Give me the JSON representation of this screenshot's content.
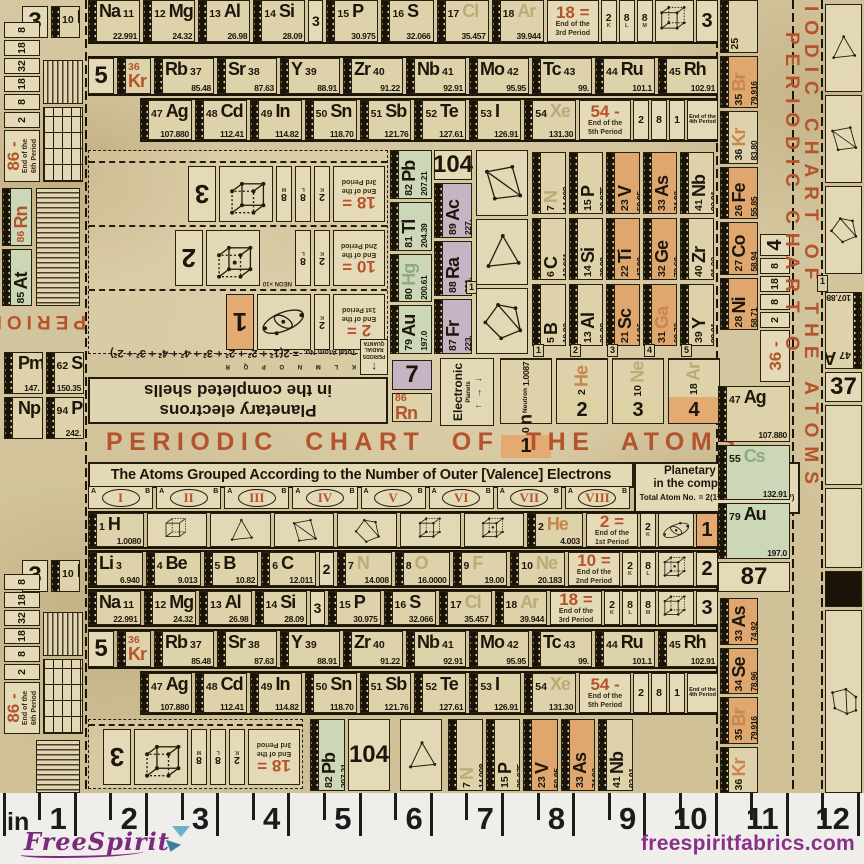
{
  "brand": {
    "name": "FreeSpirit",
    "site": "freespiritfabrics.com",
    "purple": "#7c2a80",
    "teal": "#5fa8c4"
  },
  "ruler": {
    "unit": "in",
    "nums": [
      "1",
      "2",
      "3",
      "4",
      "5",
      "6",
      "7",
      "8",
      "9",
      "10",
      "11",
      "12"
    ]
  },
  "chart": {
    "title": "PERIODIC CHART OF THE ATOMS",
    "subtitle": "The Atoms Grouped According to the Number of Outer [Valence] Electrons",
    "accent": "#b5532c",
    "groups": {
      "numerals": [
        "I",
        "II",
        "III",
        "IV",
        "V",
        "VI",
        "VII",
        "VIII"
      ],
      "a": "A",
      "b": "B"
    },
    "legend": {
      "l1": "Planetary electrons",
      "l2": "in the completed shells",
      "label": "Total Atom No.",
      "eq": "= 2(1²· 2²· 3²· 4²· 4²· 3²· 2²)"
    },
    "planetary": {
      "l1": "Planetary electrons",
      "l2": "in the completed shells",
      "label": "Total Atom No.",
      "letters": "K L M N O P Q R",
      "eq": "= 2(1² + 2² + 2² + 3² + 4² + 4² + 3² + 2²)",
      "axis_v": "PERIODS",
      "axis_h": "RADIAL QUANTA",
      "arrow": "↑"
    },
    "electronic": {
      "title": "Electronic",
      "sub": "Planets",
      "arrows": "↑ → ↓"
    },
    "vertical_title": {
      "t1": "IODIC CHART OF THE ATOMS",
      "t2": "PERIODIC CHART O"
    },
    "selvage_title_fragment": "PERIODIC"
  },
  "rows": {
    "p3": [
      {
        "n": "11",
        "s": "Na",
        "w": "22.991",
        "f": 1
      },
      {
        "n": "12",
        "s": "Mg",
        "w": "24.32"
      },
      {
        "n": "13",
        "s": "Al",
        "w": "26.98"
      },
      {
        "n": "14",
        "s": "Si",
        "w": "28.09"
      },
      {
        "d": "3"
      },
      {
        "n": "15",
        "s": "P",
        "w": "30.975"
      },
      {
        "n": "16",
        "s": "S",
        "w": "32.066"
      },
      {
        "n": "17",
        "s": "Cl",
        "w": "35.457",
        "c": "ghost"
      },
      {
        "n": "18",
        "s": "Ar",
        "w": "39.944",
        "c": "ghost"
      }
    ],
    "p5a": [
      {
        "k": "idx",
        "n": "5"
      },
      {
        "n": "36",
        "s": "Kr",
        "c": "kr2 stack"
      },
      {
        "n": "37",
        "s": "Rb",
        "w": "85.48",
        "f": 1
      },
      {
        "n": "38",
        "s": "Sr",
        "w": "87.63",
        "f": 1
      },
      {
        "n": "39",
        "s": "Y",
        "w": "88.91",
        "f": 1
      },
      {
        "n": "40",
        "s": "Zr",
        "w": "91.22",
        "f": 1
      },
      {
        "n": "41",
        "s": "Nb",
        "w": "92.91",
        "f": 1
      },
      {
        "n": "42",
        "s": "Mo",
        "w": "95.95",
        "f": 1
      },
      {
        "n": "43",
        "s": "Tc",
        "w": "99.",
        "f": 1
      },
      {
        "n": "44",
        "s": "Ru",
        "w": "101.1"
      },
      {
        "n": "45",
        "s": "Rh",
        "w": "102.91"
      }
    ],
    "p5b": [
      {
        "n": "47",
        "s": "Ag",
        "w": "107.880"
      },
      {
        "n": "48",
        "s": "Cd",
        "w": "112.41"
      },
      {
        "n": "49",
        "s": "In",
        "w": "114.82"
      },
      {
        "n": "50",
        "s": "Sn",
        "w": "118.70"
      },
      {
        "n": "51",
        "s": "Sb",
        "w": "121.76"
      },
      {
        "n": "52",
        "s": "Te",
        "w": "127.61"
      },
      {
        "n": "53",
        "s": "I",
        "w": "126.91"
      },
      {
        "n": "54",
        "s": "Xe",
        "w": "131.30",
        "c": "ghost"
      }
    ],
    "p1a": [
      {
        "n": "1",
        "s": "H",
        "w": "1.0080"
      }
    ],
    "p1b": [
      {
        "n": "2",
        "s": "He",
        "w": "4.003",
        "c": "ghostO"
      }
    ],
    "p2": [
      {
        "n": "3",
        "s": "Li",
        "w": "6.940",
        "f": 1
      },
      {
        "n": "4",
        "s": "Be",
        "w": "9.013"
      },
      {
        "n": "5",
        "s": "B",
        "w": "10.82"
      },
      {
        "n": "6",
        "s": "C",
        "w": "12.011"
      },
      {
        "d": "2"
      },
      {
        "n": "7",
        "s": "N",
        "w": "14.008",
        "c": "ghost"
      },
      {
        "n": "8",
        "s": "O",
        "w": "16.0000",
        "c": "ghost"
      },
      {
        "n": "9",
        "s": "F",
        "w": "19.00",
        "c": "ghost"
      },
      {
        "n": "10",
        "s": "Ne",
        "w": "20.183",
        "c": "ghost"
      }
    ]
  },
  "caps": {
    "c1": {
      "big": "2 =",
      "cap": "End of the|1st Period",
      "shells": [
        "2"
      ],
      "letters": [
        "K"
      ],
      "box": "H",
      "idx": "1",
      "idxc": "ob"
    },
    "c2": {
      "big": "10 =",
      "cap": "End of the|2nd Period",
      "shells": [
        "2",
        "8"
      ],
      "letters": [
        "K",
        "L"
      ],
      "box": "G",
      "idx": "2"
    },
    "c3": {
      "big": "18 =",
      "cap": "End of the|3rd Period",
      "shells": [
        "2",
        "8",
        "8"
      ],
      "letters": [
        "K",
        "L",
        "M"
      ],
      "box": "F",
      "idx": "3"
    },
    "c54": {
      "big": "54 -",
      "cap": "End of the|5th Period",
      "shells": [
        "2",
        "8",
        "1"
      ],
      "side": "End of the|4th Period"
    },
    "c36": {
      "big": "36 -",
      "shells": [
        "2",
        "8",
        "18",
        "8"
      ],
      "idx": "4"
    },
    "c86": {
      "big": "86 -",
      "cap": "End of the|6th Period",
      "shells": [
        "2",
        "8",
        "18",
        "32",
        "18",
        "8"
      ]
    }
  },
  "mid": {
    "blocks": [
      {
        "idx": "1",
        "idxc": "ob",
        "box": "H",
        "shells": [
          "2"
        ],
        "letters": [
          "K"
        ],
        "big": "2 =",
        "cap": "End of the|1st Period"
      },
      {
        "idx": "2",
        "box": "G",
        "shells": [
          "2",
          "8"
        ],
        "letters": [
          "K",
          "L"
        ],
        "big": "10 =",
        "cap": "End of the|2nd Period",
        "note": "NEON ×10"
      },
      {
        "idx": "3",
        "box": "F",
        "shells": [
          "2",
          "8",
          "8"
        ],
        "letters": [
          "K",
          "L",
          "M"
        ],
        "big": "18 =",
        "cap": "End of the|3rd Period"
      }
    ],
    "greens": [
      {
        "n": "82",
        "s": "Pb",
        "w": "207.21",
        "c": "gbg"
      },
      {
        "n": "81",
        "s": "Tl",
        "w": "204.39",
        "c": "gbg"
      },
      {
        "n": "80",
        "s": "Hg",
        "w": "200.61",
        "c": "gbg ghostg"
      },
      {
        "n": "79",
        "s": "Au",
        "w": "197.0",
        "c": "gbg"
      }
    ],
    "purples": [
      {
        "n": "104",
        "c": "pbg",
        "k": "idx"
      },
      {
        "n": "89",
        "s": "Ac",
        "w": "227.",
        "c": "pbg"
      },
      {
        "n": "88",
        "s": "Ra",
        "w": "226.",
        "c": "pbg"
      },
      {
        "n": "87",
        "s": "Fr",
        "w": "223.",
        "c": "pbg"
      }
    ],
    "con_label": "1",
    "grid": {
      "nums": [
        "1",
        "2",
        "3",
        "4",
        "5"
      ],
      "rows": [
        [
          {
            "n": "7",
            "s": "N",
            "w": "14.008",
            "c": "ghost"
          },
          {
            "n": "15",
            "s": "P",
            "w": "30.975"
          },
          {
            "n": "23",
            "s": "V",
            "w": "50.95",
            "c": "obg"
          },
          {
            "n": "33",
            "s": "As",
            "w": "74.92",
            "c": "obg"
          },
          {
            "n": "41",
            "s": "Nb",
            "w": "92.91"
          }
        ],
        [
          {
            "n": "6",
            "s": "C",
            "w": "12.011"
          },
          {
            "n": "14",
            "s": "Si",
            "w": "28.09"
          },
          {
            "n": "22",
            "s": "Ti",
            "w": "47.90",
            "c": "obg"
          },
          {
            "n": "32",
            "s": "Ge",
            "w": "72.60",
            "c": "obg"
          },
          {
            "n": "40",
            "s": "Zr",
            "w": "91.22"
          }
        ],
        [
          {
            "n": "5",
            "s": "B",
            "w": "10.82"
          },
          {
            "n": "13",
            "s": "Al",
            "w": "26.98"
          },
          {
            "n": "21",
            "s": "Sc",
            "w": "44.96",
            "c": "obg"
          },
          {
            "n": "31",
            "s": "Ga",
            "w": "69.72",
            "c": "obg ghostO"
          },
          {
            "n": "39",
            "s": "Y",
            "w": "88.91"
          }
        ]
      ]
    },
    "electrons": [
      {
        "n": "0",
        "s": "n",
        "x": "Neutron",
        "w": "1.0087",
        "i": "1",
        "ic": "ob"
      },
      {
        "n": "2",
        "s": "He",
        "c": "ghostO",
        "i": "2",
        "ic": ""
      },
      {
        "n": "10",
        "s": "Ne",
        "c": "ghost",
        "i": "3",
        "ic": ""
      },
      {
        "n": "18",
        "s": "Ar",
        "c": "ghost",
        "i": "4",
        "ic": "ob"
      }
    ],
    "pair7": {
      "top": "7",
      "n": "86",
      "s": "Rn"
    }
  },
  "left": {
    "l3ne": [
      {
        "k": "idx",
        "n": "3"
      },
      {
        "n": "10",
        "s": "Ne"
      }
    ],
    "lrn": [
      {
        "n": "86",
        "s": "Rn",
        "w": "222.",
        "c": "gbg or"
      },
      {
        "n": "85",
        "s": "At",
        "w": "210.",
        "c": "gbg"
      }
    ],
    "lr1": [
      {
        "s": "Pm",
        "w": "147."
      },
      {
        "n": "62",
        "s": "Sm",
        "w": "150.35"
      }
    ],
    "lr2": [
      {
        "s": "Np"
      },
      {
        "n": "94",
        "s": "Pu",
        "w": "242."
      }
    ]
  },
  "right": {
    "col": [
      {
        "n": "25"
      },
      {
        "n": "35",
        "s": "Br",
        "w": "79.916",
        "c": "obg ghostO"
      },
      {
        "n": "36",
        "s": "Kr",
        "w": "83.80",
        "c": "ghostO"
      },
      {
        "n": "26",
        "s": "Fe",
        "w": "55.85",
        "c": "obg"
      },
      {
        "n": "27",
        "s": "Co",
        "w": "58.94",
        "c": "obg"
      },
      {
        "n": "28",
        "s": "Ni",
        "w": "58.71",
        "c": "obg"
      }
    ],
    "up": [
      {
        "n": "47",
        "s": "Ag",
        "w": "107.880"
      },
      {
        "n": "55",
        "s": "Cs",
        "w": "132.91",
        "c": "gbg ghostg"
      },
      {
        "n": "79",
        "s": "Au",
        "w": "197.0",
        "c": "gbg"
      },
      {
        "n": "87",
        "c": "pbg",
        "k": "idx"
      }
    ],
    "col2": [
      {
        "n": "33",
        "s": "As",
        "w": "74.92",
        "c": "obg"
      },
      {
        "n": "34",
        "s": "Se",
        "w": "78.96",
        "c": "obg"
      },
      {
        "n": "35",
        "s": "Br",
        "w": "79.916",
        "c": "obg ghostO"
      },
      {
        "n": "36",
        "s": "Kr",
        "c": "ghostO"
      }
    ],
    "far": [
      {
        "n": "47",
        "s": "Ag",
        "w": "107.880",
        "c": "rot180"
      },
      {
        "n": "37",
        "k": "idx"
      }
    ],
    "far_label": "1"
  },
  "bottom": {
    "list1": [
      {
        "n": "82",
        "s": "Pb",
        "w": "207.21",
        "c": "gbg"
      },
      {
        "n": "104",
        "c": "pbg",
        "k": "idx"
      }
    ]
  }
}
